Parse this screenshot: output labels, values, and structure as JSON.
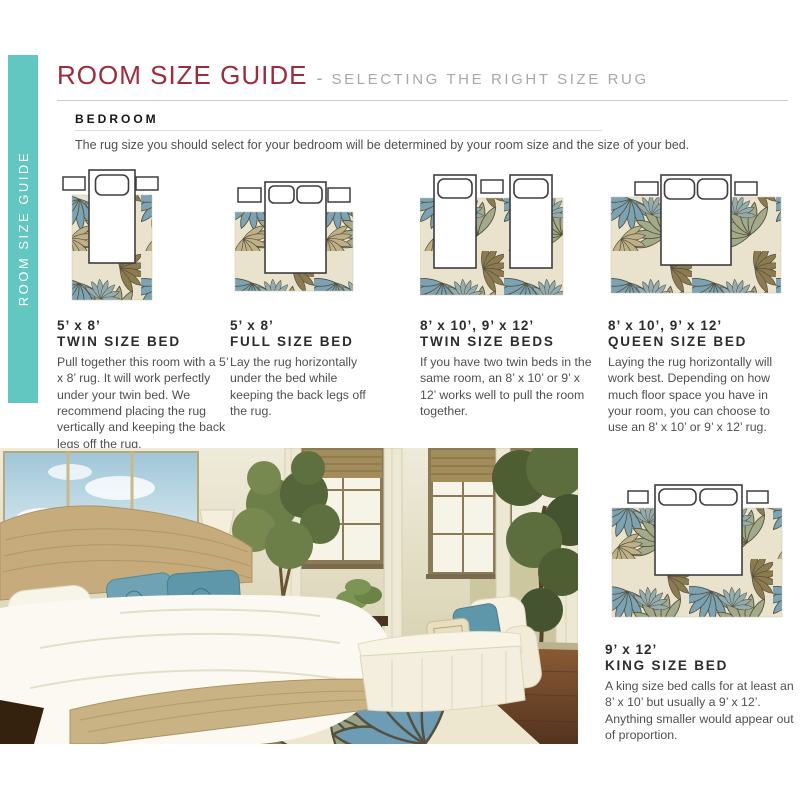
{
  "palette": {
    "teal": "#62C6C1",
    "maroon": "#9E2B3C",
    "text_gray": "#4E4F52",
    "heading_dark": "#2B2B2E",
    "rule_gray": "#C8C9CB",
    "rug_base": "#E9E3CD",
    "leaf_blue": "#7BA3B3",
    "leaf_olive": "#8C7B4F",
    "leaf_sage": "#A3AA8A",
    "leaf_tan": "#BFB085"
  },
  "sidebar": {
    "label": "ROOM SIZE GUIDE"
  },
  "header": {
    "title": "ROOM SIZE GUIDE",
    "separator": "-",
    "subtitle": "SELECTING THE RIGHT SIZE RUG"
  },
  "section": {
    "heading": "BEDROOM",
    "intro": "The rug size you should select for your bedroom will be determined by your room size and the size of your bed."
  },
  "guides": [
    {
      "size": "5’ x 8’",
      "bed": "TWIN SIZE BED",
      "description": "Pull together this room with a 5’ x 8’ rug. It will work perfectly under your twin bed. We recommend placing the rug vertically and keeping the back legs off the rug.",
      "diagram": "twin-bed-vertical-rug"
    },
    {
      "size": "5’ x 8’",
      "bed": "FULL SIZE BED",
      "description": "Lay the rug horizontally under the bed while keeping the back legs off the rug.",
      "diagram": "full-bed-horizontal-rug"
    },
    {
      "size": "8’ x 10’, 9’ x 12’",
      "bed": "TWIN SIZE BEDS",
      "description": "If you have two twin beds in the same room, an 8’ x 10’ or 9’ x 12’ works well to pull the room together.",
      "diagram": "two-twin-beds-horizontal-rug"
    },
    {
      "size": "8’ x 10’, 9’ x 12’",
      "bed": "QUEEN SIZE BED",
      "description": "Laying the rug horizontally will work best. Depending on how much floor space you have in your room, you can choose to use an 8’ x 10’ or 9’ x 12’ rug.",
      "diagram": "queen-bed-horizontal-rug"
    },
    {
      "size": "9’ x 12’",
      "bed": "KING SIZE BED",
      "description": "A king size bed calls for at least an 8’ x 10’ but usually a 9’ x 12’. Anything smaller would appear out of proportion.",
      "diagram": "king-bed-horizontal-rug"
    }
  ],
  "photo": {
    "subject": "bedroom with wicker bed, white chaise and tropical leaf rug"
  }
}
